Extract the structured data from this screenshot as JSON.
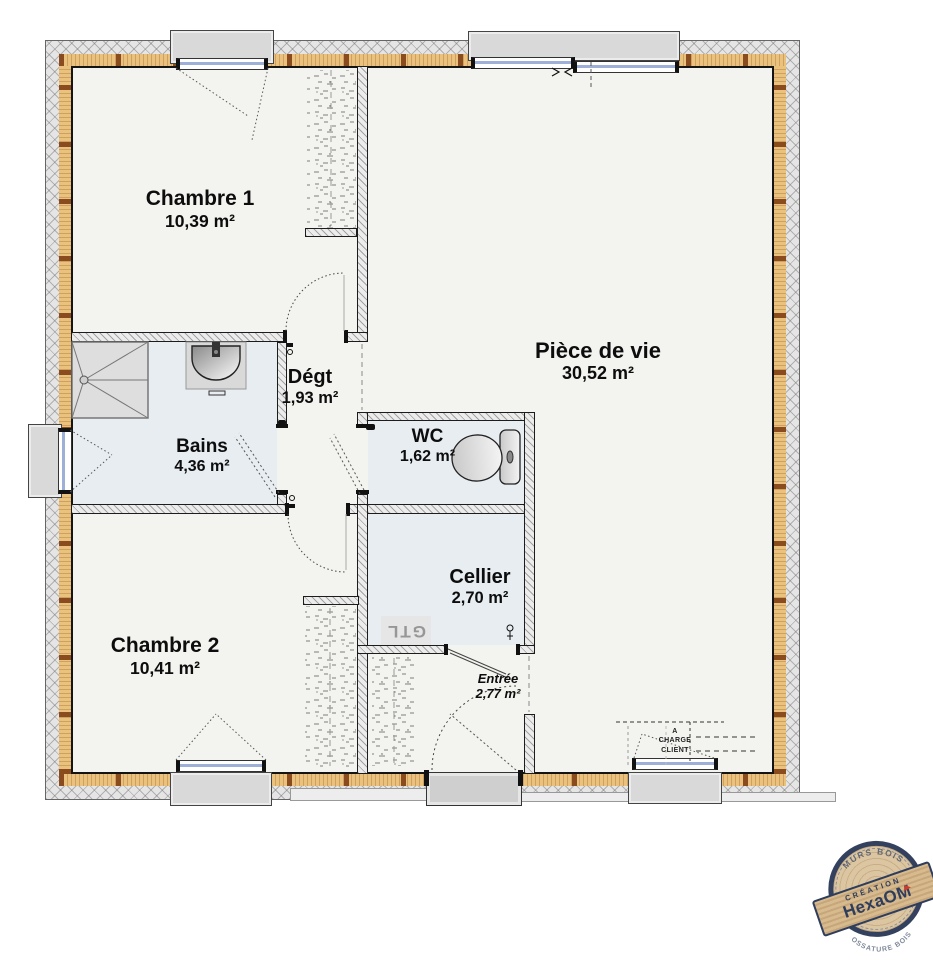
{
  "plan": {
    "rooms": {
      "chambre1": {
        "name": "Chambre 1",
        "area": "10,39 m²"
      },
      "piece_de_vie": {
        "name": "Pièce de vie",
        "area": "30,52 m²"
      },
      "degt": {
        "name": "Dégt",
        "area": "1,93 m²"
      },
      "bains": {
        "name": "Bains",
        "area": "4,36 m²"
      },
      "wc": {
        "name": "WC",
        "area": "1,62 m²"
      },
      "cellier": {
        "name": "Cellier",
        "area": "2,70 m²"
      },
      "chambre2": {
        "name": "Chambre 2",
        "area": "10,41 m²"
      },
      "entree": {
        "name": "Entrée",
        "area": "2,77 m²"
      }
    },
    "annotations": {
      "gtl": "GTL",
      "client_charge": {
        "line1": "A",
        "line2": "CHARGE",
        "line3": "CLIENT"
      }
    },
    "fixtures": [
      "shower-tray-icon",
      "washbasin-icon",
      "toilet-icon",
      "door-handle-icon"
    ]
  },
  "stamp": {
    "creation_label": "CRÉATION",
    "brand": "HexaOM",
    "arc_top": "MURS BOIS",
    "arc_bottom": "OSSATURE BOIS"
  },
  "colors": {
    "insulation_tan": "#eac27e",
    "stud_brown": "#8a4b1e",
    "hatch_gray": "#e5e5e5",
    "floor": "#f3f3ef",
    "wet_floor": "#e8edf2",
    "glass_blue": "#9fb0d8",
    "stamp_navy": "#2f3d5c",
    "stamp_red": "#d03a2b",
    "stamp_wood": "#d7ba8d"
  }
}
